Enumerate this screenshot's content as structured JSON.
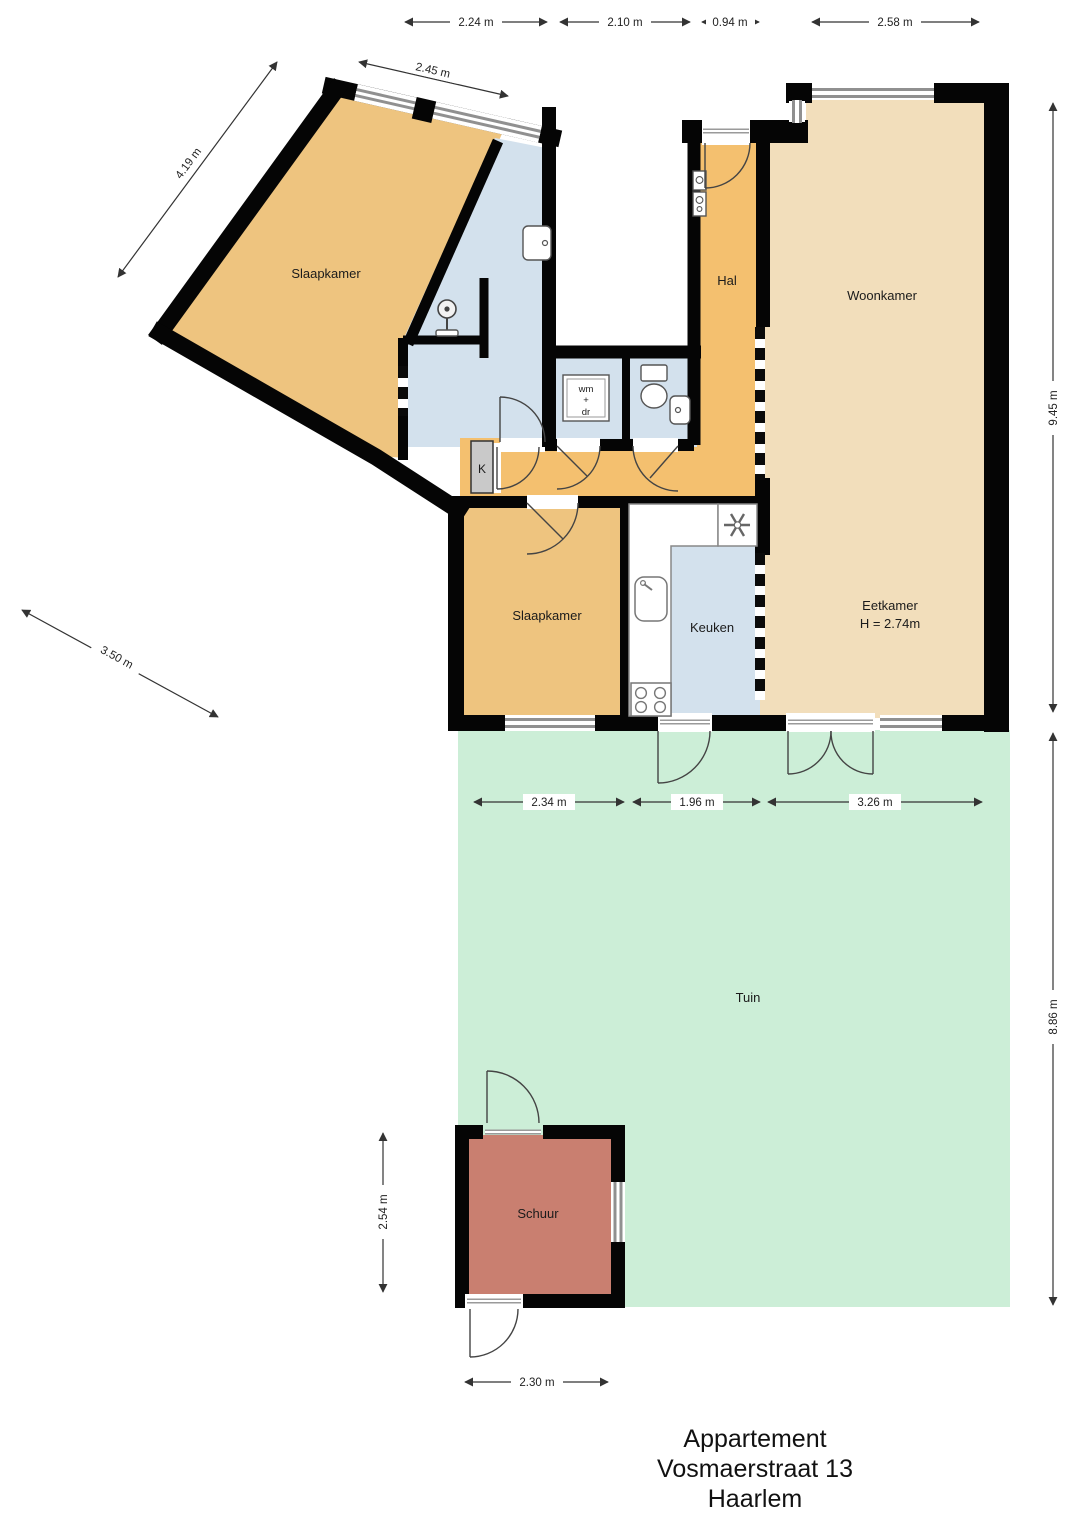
{
  "title": {
    "line1": "Appartement",
    "line2": "Vosmaerstraat 13",
    "line3": "Haarlem"
  },
  "rooms": {
    "slaapkamer1": "Slaapkamer",
    "slaapkamer2": "Slaapkamer",
    "hal": "Hal",
    "woonkamer": "Woonkamer",
    "eetkamer": "Eetkamer",
    "eetkamer_height": "H = 2.74m",
    "keuken": "Keuken",
    "tuin": "Tuin",
    "schuur": "Schuur",
    "kast": "K",
    "wm": "wm",
    "plus": "+",
    "dr": "dr"
  },
  "dimensions": {
    "top": [
      "2.24 m",
      "2.10 m",
      "0.94 m",
      "2.58 m"
    ],
    "angled": {
      "top_edge": "2.45 m",
      "left_edge": "4.19 m",
      "lower_left": "3.50 m"
    },
    "right": [
      "9.45 m",
      "8.86 m"
    ],
    "garden": [
      "2.34 m",
      "1.96 m",
      "3.26 m"
    ],
    "schuur": {
      "height": "2.54 m",
      "width": "2.30 m"
    }
  },
  "colors": {
    "room_orange": "#eec47f",
    "hall_orange": "#f4c06f",
    "room_tan": "#f2debb",
    "room_blue": "#d3e1ed",
    "garden_green": "#cceed7",
    "shed_red": "#c97f70",
    "closet_gray": "#c9c9c9",
    "wall_black": "#050505",
    "window_gray": "#909090"
  }
}
